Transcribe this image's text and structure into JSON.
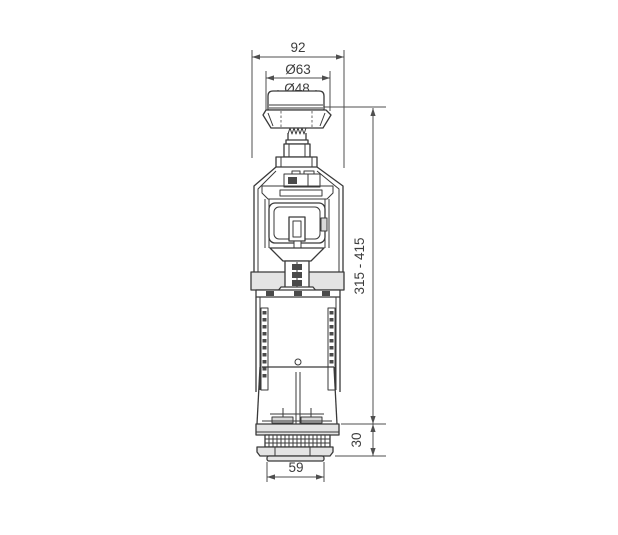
{
  "page": {
    "background_color": "#ffffff"
  },
  "diagram": {
    "type": "technical-line-drawing",
    "line_color": "#3a3a3a",
    "dimension_color": "#4f4f4f",
    "shade_color": "#e4e4e4",
    "dimensions": {
      "width_overall": "92",
      "button_outer_dia": "Ø63",
      "button_inner_dia": "Ø48",
      "height_range": "315 - 415",
      "base_height": "30",
      "base_width": "59"
    }
  }
}
